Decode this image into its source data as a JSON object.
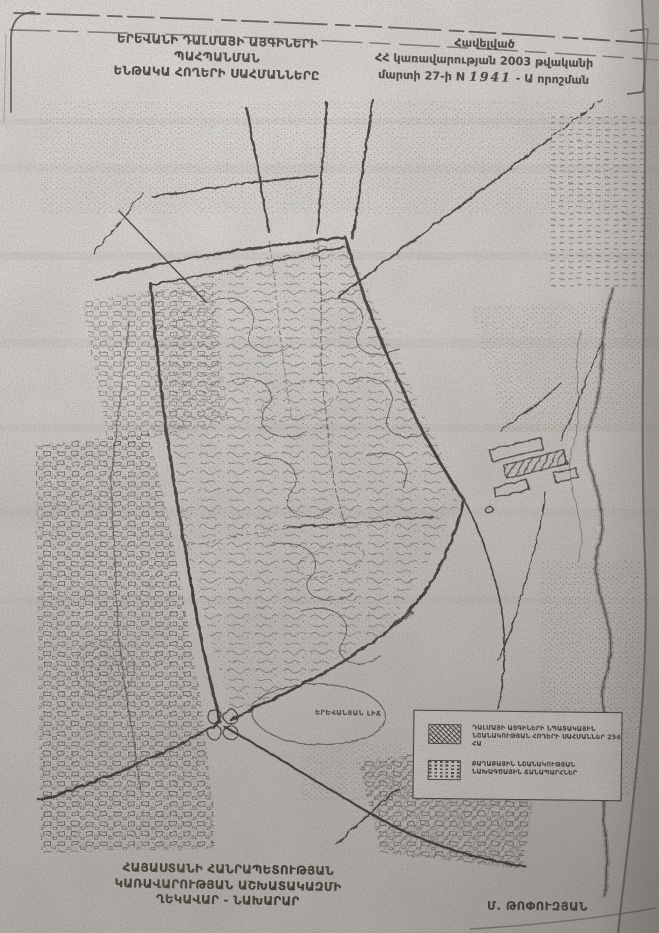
{
  "document": {
    "header": {
      "title_line1": "ԵՐԵՎԱՆԻ ԴԱԼՄԱՅԻ ԱՅԳԻՆԵՐԻ ՊԱՀՊԱՆՄԱՆ",
      "title_line2": "ԵՆԹԱԿԱ ՀՈՂԵՐԻ ՍԱՀՄԱՆՆԵՐԸ"
    },
    "appendix": {
      "line1": "Հավելված",
      "line2": "ՀՀ կառավարության 2003 թվականի",
      "line3_prefix": "մարտի 27-ի N",
      "decree_number": "1941",
      "line3_suffix": "- Ա որոշման"
    },
    "footer": {
      "line1": "ՀԱՅԱՍՏԱՆԻ ՀԱՆՐԱՊԵՏՈՒԹՅԱՆ",
      "line2": "ԿԱՌԱՎԱՐՈՒԹՅԱՆ ԱՇԽԱՏԱԿԱԶՄԻ",
      "line3": "ՂԵԿԱՎԱՐ - ՆԱԽԱՐԱՐ",
      "signature": "Մ. ԹՈՓՈՒԶՅԱՆ"
    }
  },
  "map": {
    "labels": {
      "lake": "ԵՐԵՎԱՆՅԱՆ ԼԻՃ",
      "street": "ՓՈՂՈՑ"
    },
    "legend": {
      "items": [
        {
          "symbol": "crosshatch",
          "line1": "ԴԱԼՄԱՅԻ ԱՅԳԻՆԵՐԻ ՆՊԱՏԱԿԱՅԻՆ",
          "line2": "ՆՇԱՆԱԿՈՒԹՅԱՆ ՀՈՂԵՐԻ ՍԱՀՄԱՆՆԵՐ 254 ՀԱ"
        },
        {
          "symbol": "dashes",
          "line1": "ՔԱՂԱՔԱՅԻՆ ՆՇԱՆԱԿՈՒԹՅԱՆ",
          "line2": "ՆԱԽԱԳԾԱՅԻՆ ՃԱՆԱՊԱՐՀՆԵՐ"
        }
      ]
    }
  },
  "colors": {
    "paper": "#cdcac4",
    "ink": "#39352e",
    "map_ink": "#262420"
  }
}
